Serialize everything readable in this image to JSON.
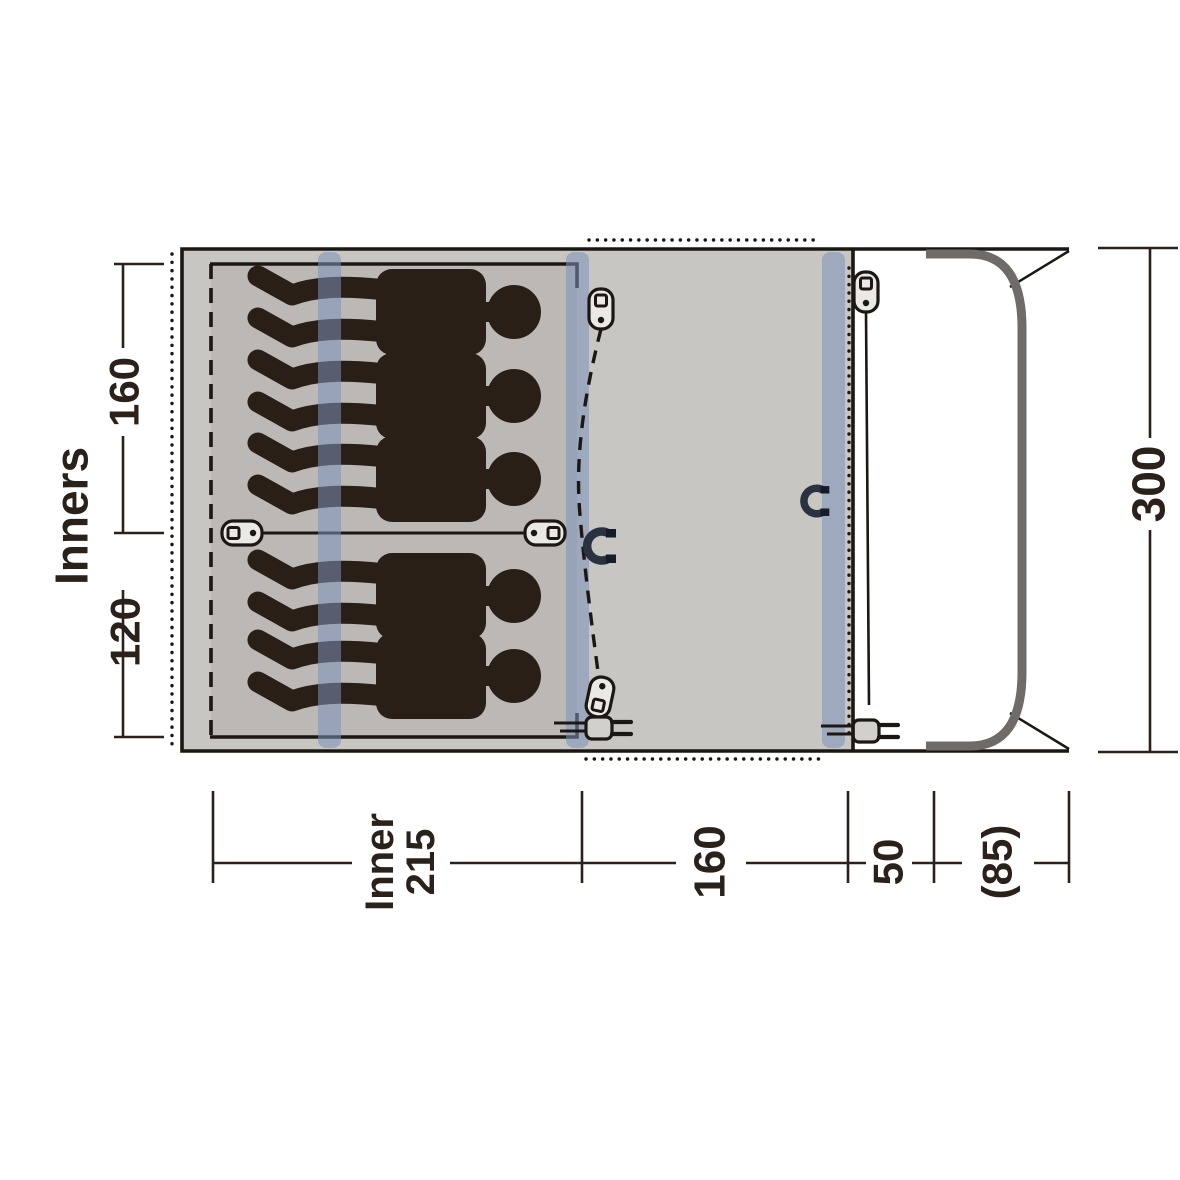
{
  "page": {
    "type": "tent-floor-plan-diagram",
    "view": "top-down"
  },
  "floorplan": {
    "sleeping_capacity": 5,
    "areas": [
      "inner-tent",
      "living-area",
      "front-porch"
    ],
    "icons": [
      "zipper-pull-icon",
      "magnet-catch-icon",
      "power-cable-entry-icon",
      "pole-stripe",
      "person-silhouette"
    ]
  },
  "dimensions": {
    "left_title": "Inners",
    "left_segments": [
      "160",
      "120"
    ],
    "right_total": "300",
    "bottom_seg1_line1": "Inner",
    "bottom_seg1_line2": "215",
    "bottom_seg2": "160",
    "bottom_seg3": "50",
    "bottom_seg4": "(85)"
  },
  "colors": {
    "bg": "#ffffff",
    "floor": "#c8c6c3",
    "inner-floor": "#bbb8b5",
    "stripe": "rgba(126,145,184,0.55)",
    "silhouette": "#2a1f17",
    "line": "#1c1712",
    "text": "#2a211a",
    "porch-pole": "#6f6b68",
    "icon-fill": "#ebe9e6",
    "plug-fill": "#d2d0cd",
    "magnet": "#2a3240",
    "magnet-tip": "#161c28"
  }
}
